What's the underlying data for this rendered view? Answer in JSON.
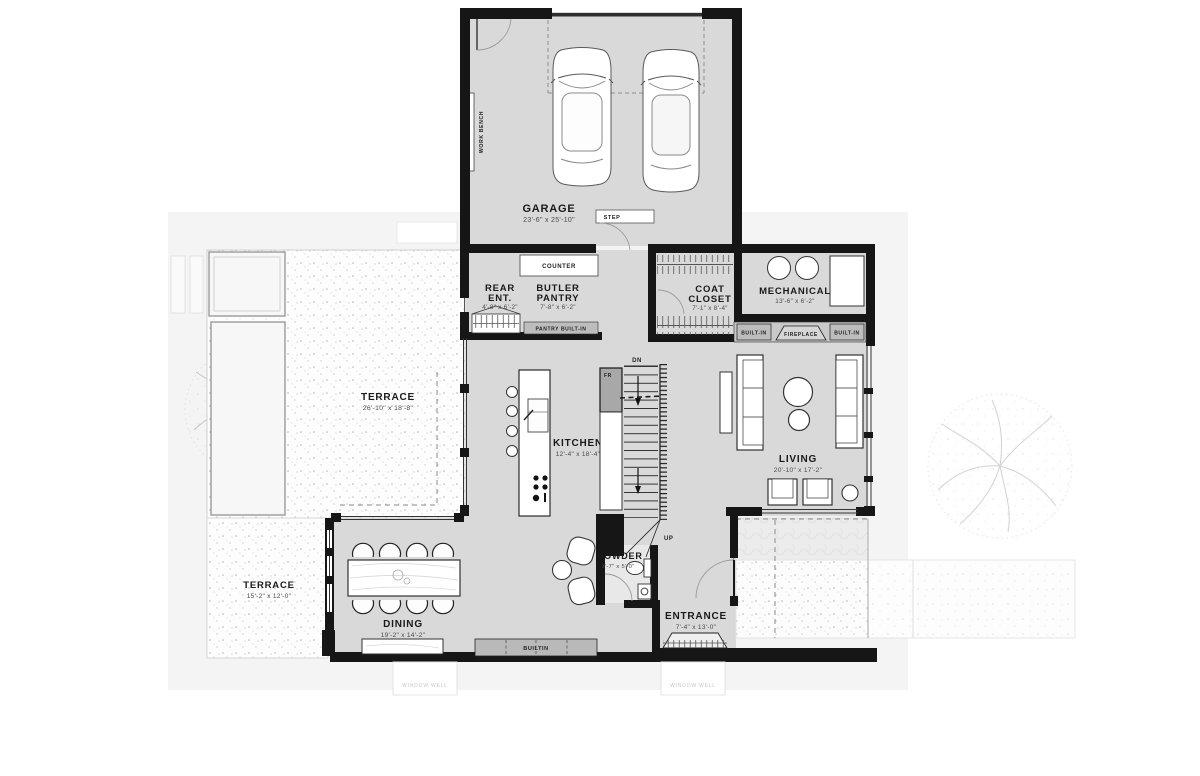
{
  "plan_type": "first-floor-plan",
  "rooms": {
    "garage": {
      "name": "GARAGE",
      "dims": "23'-6\" x 25'-10\""
    },
    "rear_ent": {
      "line1": "REAR",
      "line2": "ENT.",
      "dims": "4'-8\" x 6'-2\""
    },
    "butler_pantry": {
      "line1": "BUTLER",
      "line2": "PANTRY",
      "dims": "7'-8\" x 6'-2\""
    },
    "coat_closet": {
      "line1": "COAT",
      "line2": "CLOSET",
      "dims": "7'-1\" x 8'-4\""
    },
    "mechanical": {
      "name": "MECHANICAL",
      "dims": "13'-6\" x 6'-2\""
    },
    "terrace_main": {
      "name": "TERRACE",
      "dims": "26'-10\" x 18'-8\""
    },
    "terrace_small": {
      "name": "TERRACE",
      "dims": "15'-2\" x 12'-0\""
    },
    "kitchen": {
      "name": "KITCHEN",
      "dims": "12'-4\" x 18'-4\""
    },
    "living": {
      "name": "LIVING",
      "dims": "20'-10\" x 17'-2\""
    },
    "dining": {
      "name": "DINING",
      "dims": "19'-2\" x 14'-2\""
    },
    "powder": {
      "name": "POWDER",
      "dims": "3'-7\" x 5'-0\""
    },
    "entrance": {
      "name": "ENTRANCE",
      "dims": "7'-4\" x 13'-0\""
    }
  },
  "fixtures": {
    "counter": "COUNTER",
    "step": "STEP",
    "work_bench": "WORK BENCH",
    "pantry_built_in": "PANTRY BUILT-IN",
    "built_in_left": "BUILT-IN",
    "fireplace": "FIREPLACE",
    "built_in_right": "BUILT-IN",
    "builtin": "BUILTIN",
    "window_well_left": "WINDOW WELL",
    "window_well_right": "WINDOW WELL",
    "dn": "DN",
    "up": "UP",
    "fr": "FR"
  },
  "colors": {
    "wall": "#161616",
    "floor": "#d9d9d9",
    "cabinet_gray": "#bdbdbd",
    "site": "#f4f4f4",
    "label": "#1a1a1a",
    "dim_text": "#4a4a4a",
    "ghost_text": "#c6c6c6"
  }
}
